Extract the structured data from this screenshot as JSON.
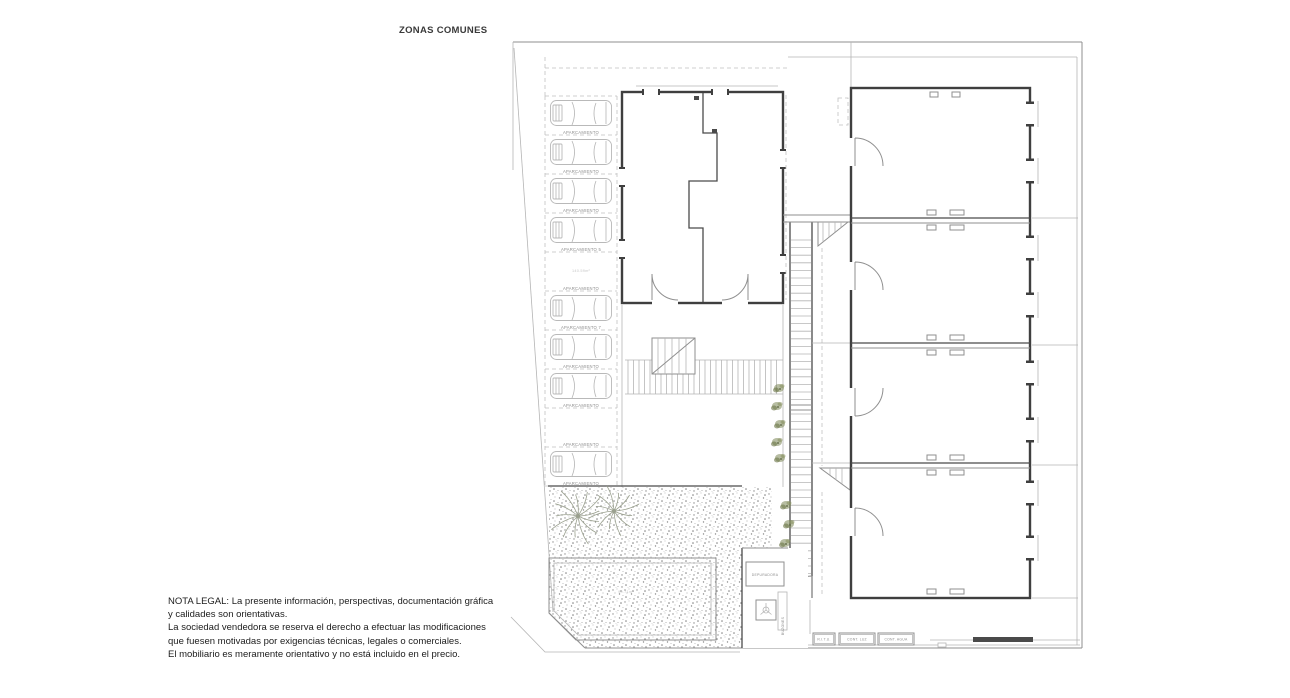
{
  "title": "ZONAS COMUNES",
  "legal_note": {
    "lines": [
      "NOTA LEGAL: La presente información, perspectivas, documentación gráfica",
      "y calidades son orientativas.",
      "La sociedad vendedora se reserva el derecho a efectuar las modificaciones",
      "que fuesen motivadas por exigencias técnicas, legales o comerciales.",
      "El mobiliario es meramente orientativo y no está incluido en el precio."
    ]
  },
  "plan": {
    "parking": {
      "stalls": [
        {
          "label": "APARCAMIENTO",
          "has_car": true
        },
        {
          "label": "APARCAMIENTO",
          "has_car": true
        },
        {
          "label": "APARCAMIENTO",
          "has_car": true
        },
        {
          "label": "APARCAMIENTO 5",
          "has_car": true
        },
        {
          "label": "APARCAMIENTO",
          "has_car": false
        },
        {
          "label": "APARCAMIENTO 7",
          "has_car": true
        },
        {
          "label": "APARCAMIENTO",
          "has_car": true
        },
        {
          "label": "APARCAMIENTO",
          "has_car": true
        },
        {
          "label": "APARCAMIENTO",
          "has_car": false
        },
        {
          "label": "APARCAMIENTO",
          "has_car": true
        }
      ],
      "area_note": "140.59m²"
    },
    "pool": {
      "area_label": "90.71m²"
    },
    "rooms": {
      "depuradora_label": "DEPURADORA",
      "buzones_label": "BUZONES"
    },
    "utilities": [
      {
        "label": "R.I.T.U."
      },
      {
        "label": "CONT. LUZ"
      },
      {
        "label": "CONT. AGUA"
      }
    ],
    "colors": {
      "wall": "#3f3f3f",
      "line_light": "#b5b5b5",
      "line_mid": "#8f8f8f",
      "label_text": "#8c8c8c",
      "plant_green": "#7b8655",
      "palm_gray": "#9aa08e",
      "note_text": "#1c1c1c"
    }
  }
}
